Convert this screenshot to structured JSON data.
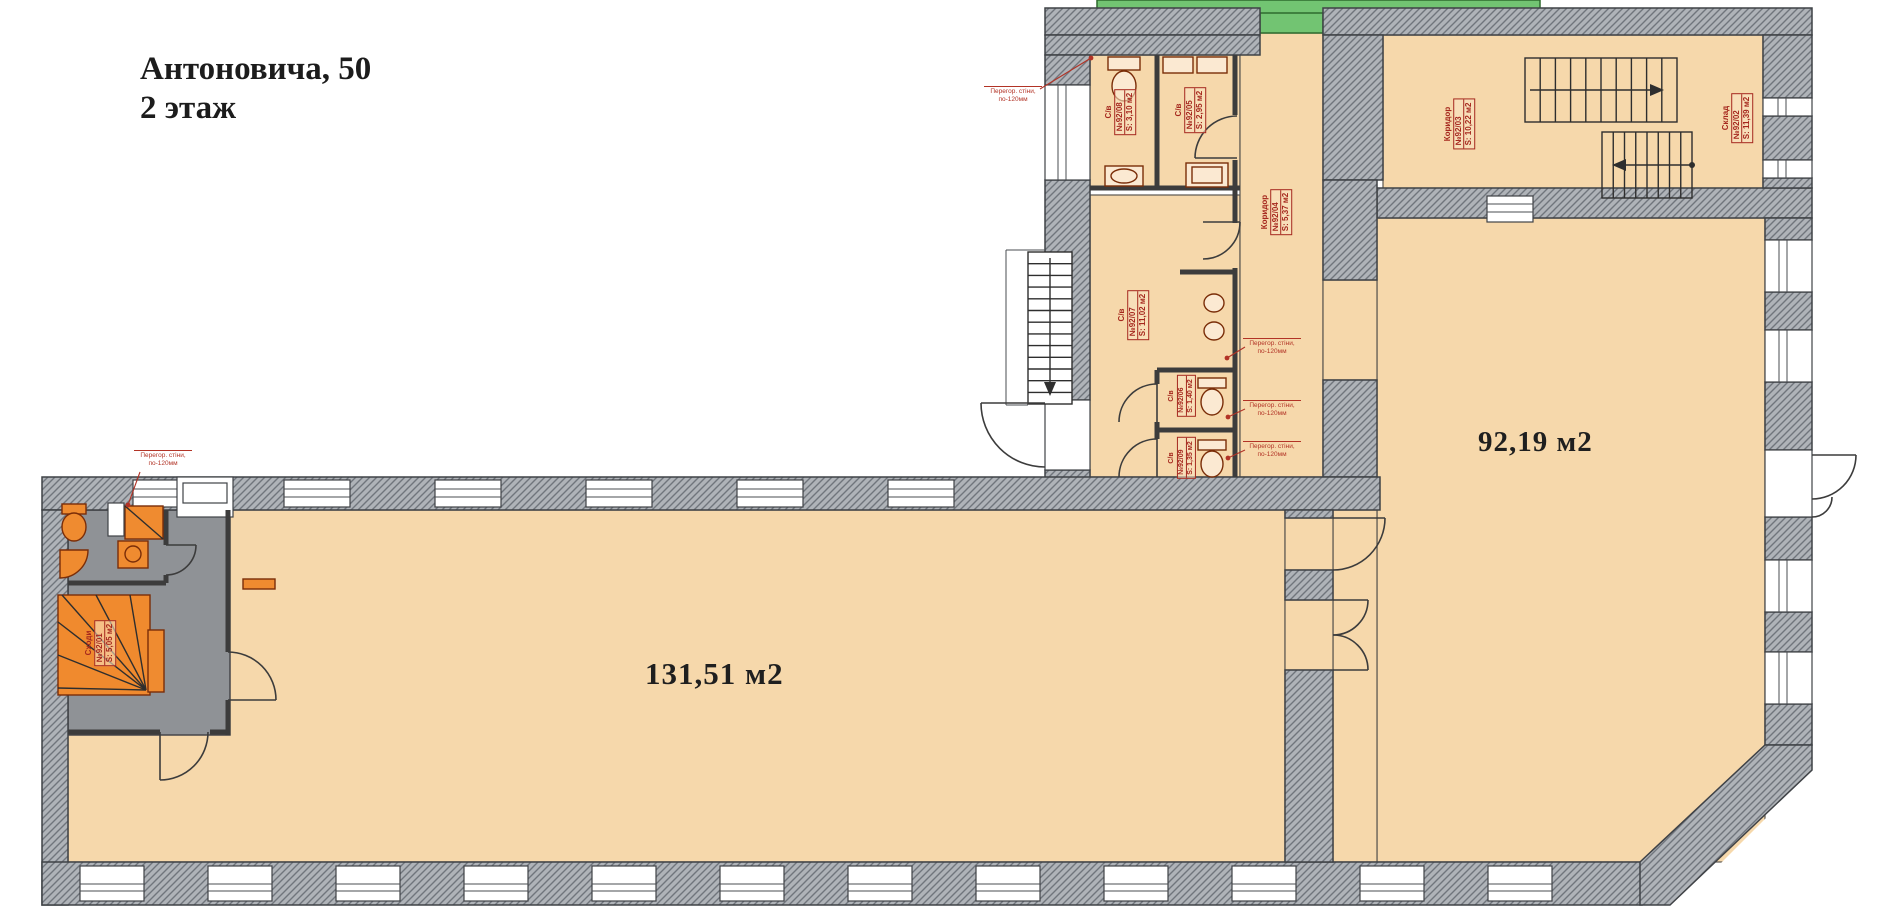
{
  "palette": {
    "floor": "#f6d8ab",
    "wall_base": "#afb3b8",
    "wall_line": "#70757c",
    "wall_stroke": "#3f4246",
    "gray_zone": "#8f9296",
    "green": "#72c472",
    "green_dark": "#2e6b2e",
    "label_red": "#a5271d",
    "note_red": "#b23326",
    "fixture_orange": "#ef8b30",
    "fixture_dark": "#7a2d08",
    "thin_wall": "#3c3c3c",
    "ink": "#1c1c1c"
  },
  "title": {
    "line1": "Антоновича, 50",
    "line2": "2 этаж"
  },
  "areas": [
    {
      "id": "room-92",
      "text": "92,19 м2"
    },
    {
      "id": "room-131",
      "text": "131,51 м2"
    }
  ],
  "room_labels": [
    {
      "id": "wc-92-08",
      "type": "С/в",
      "number": "№92/08",
      "area": "S: 3,10 м2"
    },
    {
      "id": "wc-92-05",
      "type": "С/в",
      "number": "№92/05",
      "area": "S: 2,95 м2"
    },
    {
      "id": "kor-92-04",
      "type": "Коридор",
      "number": "№92/04",
      "area": "S: 5,37 м2"
    },
    {
      "id": "wc-92-07",
      "type": "С/в",
      "number": "№92/07",
      "area": "S: 11,02 м2"
    },
    {
      "id": "wc-92-06",
      "type": "С/в",
      "number": "№92/06",
      "area": "S: 1,40 м2"
    },
    {
      "id": "wc-92-09",
      "type": "С/в",
      "number": "№92/09",
      "area": "S: 1,35 м2"
    },
    {
      "id": "kor-92-03",
      "type": "Коридор",
      "number": "№92/03",
      "area": "S: 10,22 м2"
    },
    {
      "id": "sklad-92-02",
      "type": "Склад",
      "number": "№92/02",
      "area": "S: 11,39 м2"
    },
    {
      "id": "skhody-92-01",
      "type": "Сходи",
      "number": "№92/01",
      "area": "S: 5,05 м2"
    }
  ],
  "annotations": {
    "partition_note_line1": "Перегор. стіни,",
    "partition_note_line2": "по-120мм"
  }
}
